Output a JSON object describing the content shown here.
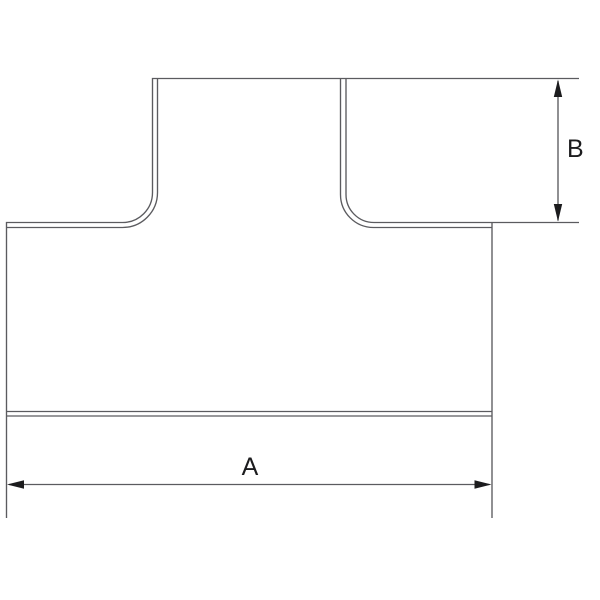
{
  "drawing": {
    "kind": "technical-line-drawing",
    "subject": "tee-fitting-front-view",
    "background": "#ffffff",
    "line_color": "#5b5b5f",
    "dim_color": "#1c1c1e",
    "dimensions": {
      "a": {
        "label": "A",
        "orientation": "horizontal"
      },
      "b": {
        "label": "B",
        "orientation": "vertical"
      }
    }
  }
}
